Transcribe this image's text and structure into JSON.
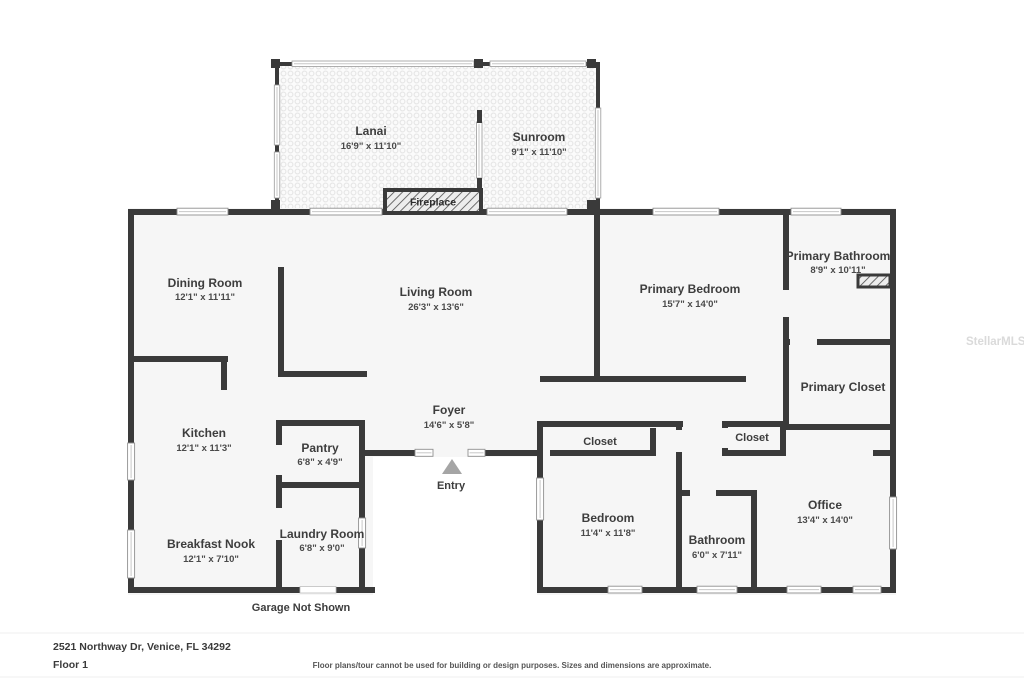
{
  "plan": {
    "address": "2521 Northway Dr, Venice, FL 34292",
    "floor_label": "Floor 1",
    "disclaimer": "Floor plans/tour cannot be used for building or design purposes. Sizes and dimensions are approximate.",
    "watermark": "StellarMLS",
    "garage_note": "Garage Not Shown",
    "entry_label": "Entry",
    "fireplace_label": "Fireplace",
    "colors": {
      "wall": "#3a3a3a",
      "floor": "#f6f6f6",
      "label": "#3d3d3d",
      "entry_arrow": "#a5a5a5",
      "watermark": "#dadada",
      "background": "#ffffff"
    },
    "rooms": {
      "lanai": {
        "name": "Lanai",
        "dims": "16'9\" x 11'10\""
      },
      "sunroom": {
        "name": "Sunroom",
        "dims": "9'1\" x 11'10\""
      },
      "dining_room": {
        "name": "Dining Room",
        "dims": "12'1\" x 11'11\""
      },
      "living_room": {
        "name": "Living Room",
        "dims": "26'3\" x 13'6\""
      },
      "primary_bedroom": {
        "name": "Primary Bedroom",
        "dims": "15'7\" x 14'0\""
      },
      "primary_bathroom": {
        "name": "Primary Bathroom",
        "dims": "8'9\" x 10'11\""
      },
      "primary_closet": {
        "name": "Primary Closet",
        "dims": ""
      },
      "kitchen": {
        "name": "Kitchen",
        "dims": "12'1\" x 11'3\""
      },
      "pantry": {
        "name": "Pantry",
        "dims": "6'8\" x 4'9\""
      },
      "foyer": {
        "name": "Foyer",
        "dims": "14'6\" x 5'8\""
      },
      "closet_bedroom": {
        "name": "Closet",
        "dims": ""
      },
      "closet_hall": {
        "name": "Closet",
        "dims": ""
      },
      "breakfast_nook": {
        "name": "Breakfast Nook",
        "dims": "12'1\" x 7'10\""
      },
      "laundry_room": {
        "name": "Laundry Room",
        "dims": "6'8\" x 9'0\""
      },
      "bedroom": {
        "name": "Bedroom",
        "dims": "11'4\" x 11'8\""
      },
      "bathroom": {
        "name": "Bathroom",
        "dims": "6'0\" x 7'11\""
      },
      "office": {
        "name": "Office",
        "dims": "13'4\" x 14'0\""
      }
    }
  }
}
